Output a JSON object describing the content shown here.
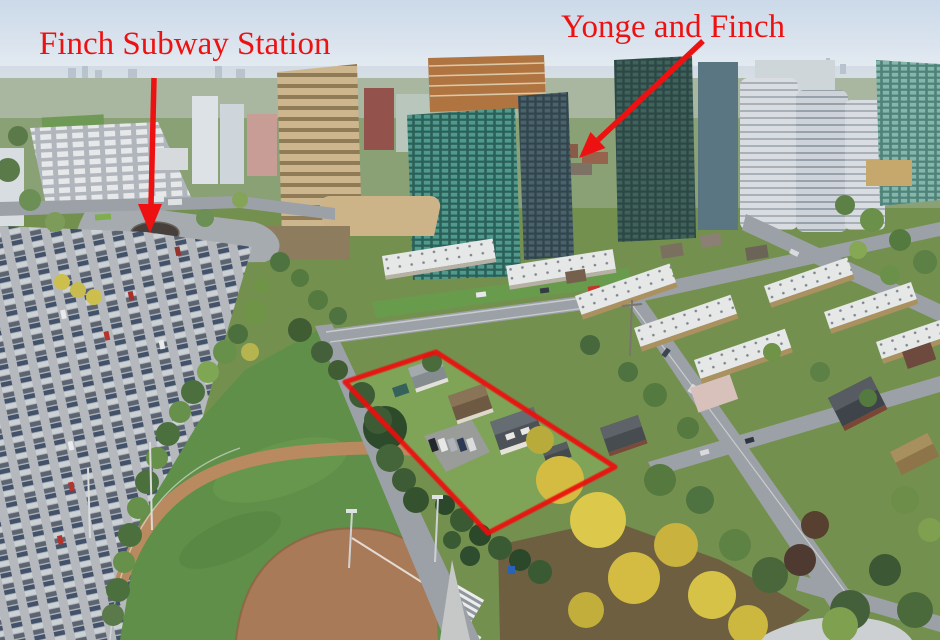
{
  "scene": {
    "kind": "annotated aerial photograph",
    "subject": "Yonge and Finch neighbourhood with commuter parking lot, Finch subway station bus loop, condo towers, stacked townhouses, park with baseball diamond, and a red-outlined development property"
  },
  "annotations": {
    "color": "#ee1111",
    "labels": [
      {
        "id": "finch-subway-station",
        "text": "Finch Subway Station"
      },
      {
        "id": "yonge-and-finch",
        "text": "Yonge and Finch"
      }
    ]
  },
  "palette": {
    "sky": "#d9e3ee",
    "haze": "#eef2f5",
    "grass_park": "#5f8f48",
    "grass_lawn": "#7fa458",
    "pavement": "#b5b9be",
    "road": "#9ba1a7",
    "infield": "#a97a57",
    "track": "#b98a60",
    "foliage": "#4e7340",
    "foliage_yellow": "#d3bc41",
    "roof_white": "#e6e8e7",
    "teal_glass": "#2a6058",
    "annotation_red": "#ee1111"
  }
}
